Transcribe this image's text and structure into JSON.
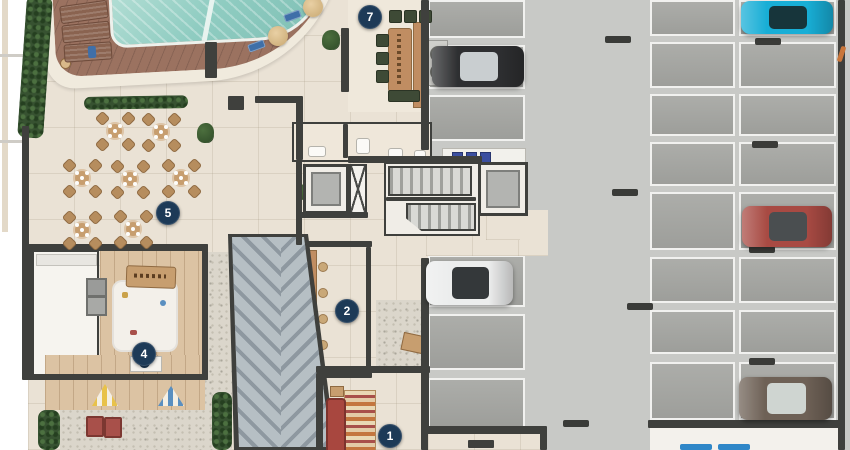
{
  "scene": {
    "type": "architectural-floor-plan",
    "description": "Residential ground-floor amenities plan (pool, deck, dining terrace, kids room, lounge, gourmet area) with adjoining parking garage"
  },
  "palette": {
    "amenity_floor": "#eae2d5",
    "garage_aisle": "#c8c9c6",
    "parking_stall": "#a7a8a4",
    "stall_line": "#f1f1ef",
    "wall": "#3f403d",
    "deck_wood": "#9b7260",
    "pool_water": "#8fccc1",
    "hedge_green": "#375231",
    "ramp_slab": "#b6bfc4",
    "marker_navy": "#1d3a57",
    "wood": "#c79e6f",
    "chair_green": "#3e4a36",
    "sofa_red": "#a8473f",
    "gravel": "#dbd6cb"
  },
  "markers": [
    {
      "label": "7",
      "x": 370,
      "y": 17
    },
    {
      "label": "5",
      "x": 168,
      "y": 213
    },
    {
      "label": "2",
      "x": 347,
      "y": 311
    },
    {
      "label": "4",
      "x": 144,
      "y": 354
    },
    {
      "label": "1",
      "x": 390,
      "y": 436
    }
  ],
  "cars": [
    {
      "name": "cyan-car",
      "x": 741,
      "y": 1,
      "w": 92,
      "h": 33,
      "body": "#18aed6",
      "glass": "#17353b"
    },
    {
      "name": "black-car",
      "x": 432,
      "y": 46,
      "w": 92,
      "h": 41,
      "body": "#2e2f31",
      "glass": "#c9ced0"
    },
    {
      "name": "red-car",
      "x": 742,
      "y": 206,
      "w": 90,
      "h": 41,
      "body": "#a84a43",
      "glass": "#4a4e50"
    },
    {
      "name": "white-car",
      "x": 426,
      "y": 261,
      "w": 87,
      "h": 44,
      "body": "#eceded",
      "glass": "#34383a"
    },
    {
      "name": "brown-car",
      "x": 739,
      "y": 377,
      "w": 93,
      "h": 43,
      "body": "#6e6156",
      "glass": "#cfd5d1"
    }
  ],
  "parking": {
    "left_column": {
      "x": 428,
      "w": 97,
      "rows": [
        [
          0,
          38
        ],
        [
          45,
          44
        ],
        [
          95,
          46
        ],
        [
          255,
          52
        ],
        [
          314,
          56
        ],
        [
          378,
          50
        ]
      ]
    },
    "right_columns": [
      {
        "x": 650,
        "w": 85
      },
      {
        "x": 739,
        "w": 97
      }
    ],
    "right_rows": [
      [
        0,
        36
      ],
      [
        42,
        46
      ],
      [
        94,
        42
      ],
      [
        142,
        44
      ],
      [
        192,
        58
      ],
      [
        257,
        46
      ],
      [
        310,
        44
      ],
      [
        362,
        58
      ]
    ],
    "wheel_stops": [
      [
        605,
        36
      ],
      [
        612,
        189
      ],
      [
        627,
        303
      ],
      [
        563,
        420
      ],
      [
        755,
        38
      ],
      [
        752,
        141
      ],
      [
        749,
        246
      ],
      [
        749,
        358
      ]
    ]
  },
  "terrace_tables": [
    [
      115,
      131
    ],
    [
      161,
      132
    ],
    [
      82,
      178
    ],
    [
      130,
      179
    ],
    [
      181,
      178
    ],
    [
      82,
      230
    ],
    [
      133,
      229
    ]
  ],
  "sun_loungers": [
    [
      60,
      3,
      -8
    ],
    [
      62,
      23,
      -6
    ],
    [
      64,
      43,
      -4
    ]
  ],
  "pool_umbrellas": [
    [
      268,
      26
    ],
    [
      303,
      -3
    ]
  ],
  "pool_side_chairs": [
    [
      248,
      42,
      -20
    ],
    [
      284,
      12,
      -20
    ]
  ],
  "area7_chairs": {
    "top_row": [
      [
        389,
        10
      ],
      [
        404,
        10
      ],
      [
        419,
        10
      ]
    ],
    "left_col": [
      [
        376,
        34
      ],
      [
        376,
        52
      ],
      [
        376,
        70
      ]
    ],
    "bench": [
      388,
      90,
      30,
      10
    ]
  },
  "bar_stools": [
    [
      318,
      262
    ],
    [
      318,
      288
    ],
    [
      318,
      314
    ],
    [
      318,
      340
    ]
  ],
  "locker_boxes": [
    [
      452,
      152
    ],
    [
      466,
      152
    ],
    [
      480,
      152
    ]
  ],
  "blue_mats": [
    [
      680,
      444
    ],
    [
      718,
      444
    ]
  ],
  "bathroom_fixtures": [
    [
      308,
      146,
      16,
      9
    ],
    [
      356,
      138,
      12,
      14
    ],
    [
      388,
      148,
      13,
      8
    ],
    [
      414,
      150,
      10,
      7
    ]
  ]
}
